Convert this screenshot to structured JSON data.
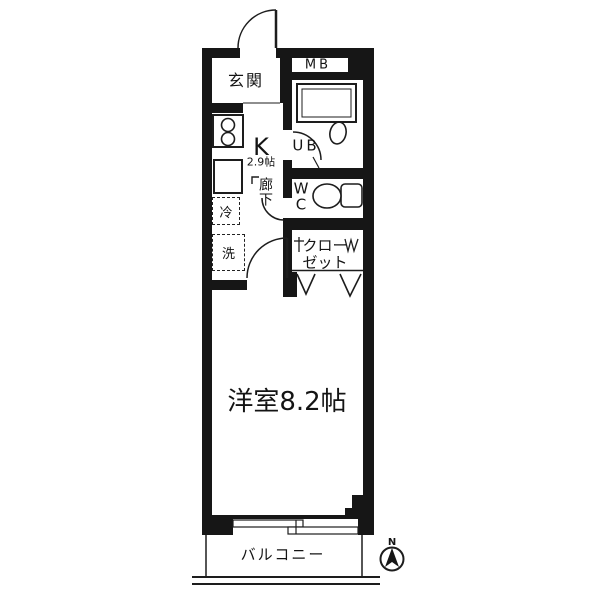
{
  "colors": {
    "background": "#ffffff",
    "wall": "#161616",
    "line": "#1d1d1d"
  },
  "rooms": {
    "entrance": {
      "label": "玄関"
    },
    "meter_box": {
      "label": "MB"
    },
    "kitchen": {
      "label": "K",
      "size": "2.9帖"
    },
    "unit_bath": {
      "label": "UB"
    },
    "corridor": {
      "label": "廊下"
    },
    "toilet": {
      "label": "WC"
    },
    "refrigerator": {
      "label": "冷"
    },
    "washer": {
      "label": "洗"
    },
    "closet": {
      "line1": "クロー",
      "line2": "ゼット"
    },
    "western_room": {
      "label": "洋室8.2帖"
    },
    "balcony": {
      "label": "バルコニー"
    }
  },
  "compass": {
    "label": "N"
  }
}
